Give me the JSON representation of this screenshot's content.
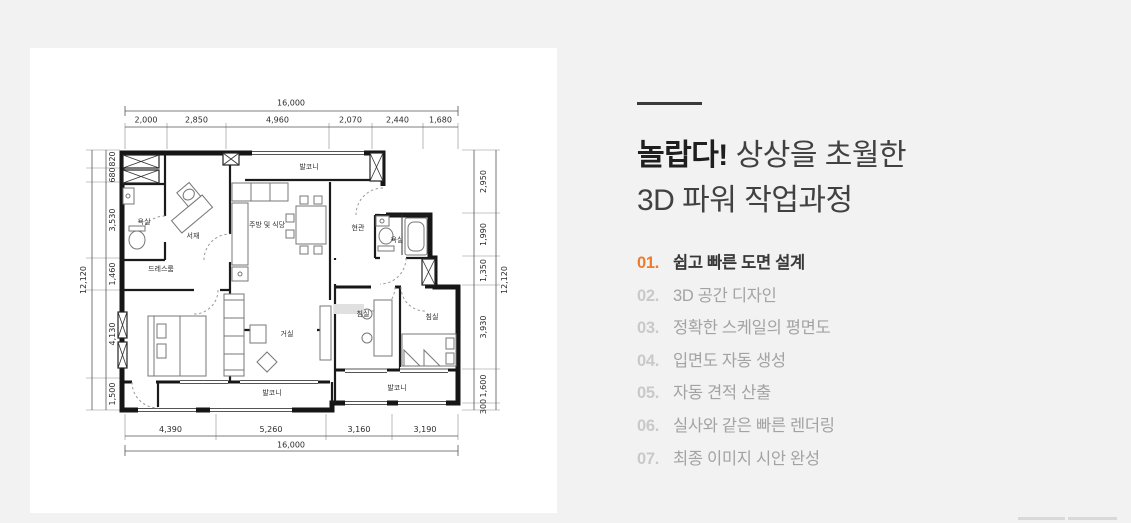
{
  "page": {
    "bg": "#f2f2f2",
    "card_bg": "#ffffff",
    "accent": "#ee7c2e"
  },
  "intro": {
    "headline_bold": "놀랍다!",
    "headline_rest": " 상상을 초월한",
    "headline_line2": "3D 파워 작업과정",
    "steps": [
      {
        "num": "01.",
        "label": "쉽고 빠른 도면 설계"
      },
      {
        "num": "02.",
        "label": "3D 공간 디자인"
      },
      {
        "num": "03.",
        "label": "정확한 스케일의 평면도"
      },
      {
        "num": "04.",
        "label": "입면도 자동 생성"
      },
      {
        "num": "05.",
        "label": "자동 견적 산출"
      },
      {
        "num": "06.",
        "label": "실사와 같은 빠른 렌더링"
      },
      {
        "num": "07.",
        "label": "최종 이미지 시안 완성"
      }
    ]
  },
  "floorplan": {
    "total_width": "16,000",
    "total_height": "12,120",
    "dims_top": [
      "2,000",
      "2,850",
      "4,960",
      "2,070",
      "2,440",
      "1,680"
    ],
    "dims_bottom": [
      "4,390",
      "5,260",
      "3,160",
      "3,190"
    ],
    "dims_left": [
      "820",
      "680",
      "3,530",
      "1,460",
      "4,130",
      "1,500"
    ],
    "dims_right": [
      "2,950",
      "1,990",
      "1,350",
      "3,930",
      "1,600",
      "300"
    ],
    "rooms": {
      "bath": "욕실",
      "study": "서재",
      "kitchen": "주방 및 식당",
      "balcony": "발코니",
      "entrance": "현관",
      "dress": "드레스룸",
      "living": "거실",
      "bedroom": "침실"
    }
  }
}
